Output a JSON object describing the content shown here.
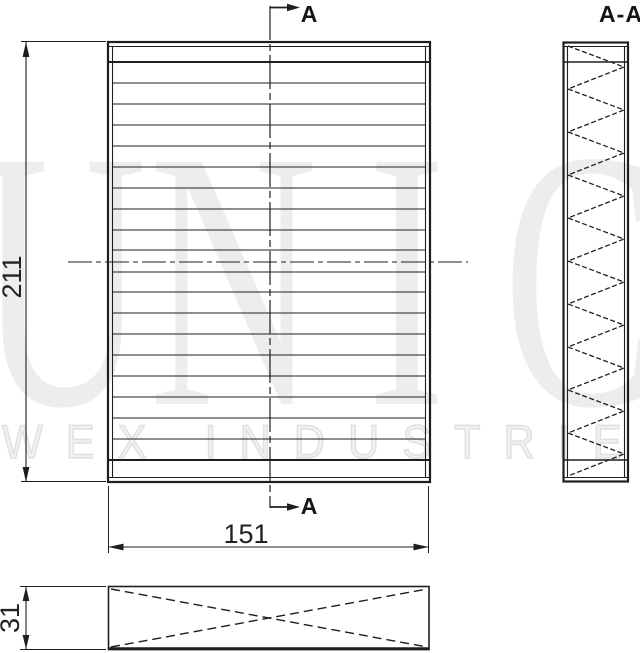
{
  "section_view": {
    "title": "A-A"
  },
  "section_marks": {
    "top_label": "A",
    "bottom_label": "A"
  },
  "dimensions": {
    "height": "211",
    "width": "151",
    "depth": "31"
  },
  "watermark": {
    "brand_letters": [
      "U",
      "N",
      "I",
      "C"
    ],
    "tagline": "WEX INDUSTRIES"
  },
  "colors": {
    "line": "#1e1e1e",
    "watermark_fill": "#ededed",
    "watermark_outline": "#e0e0e0"
  }
}
